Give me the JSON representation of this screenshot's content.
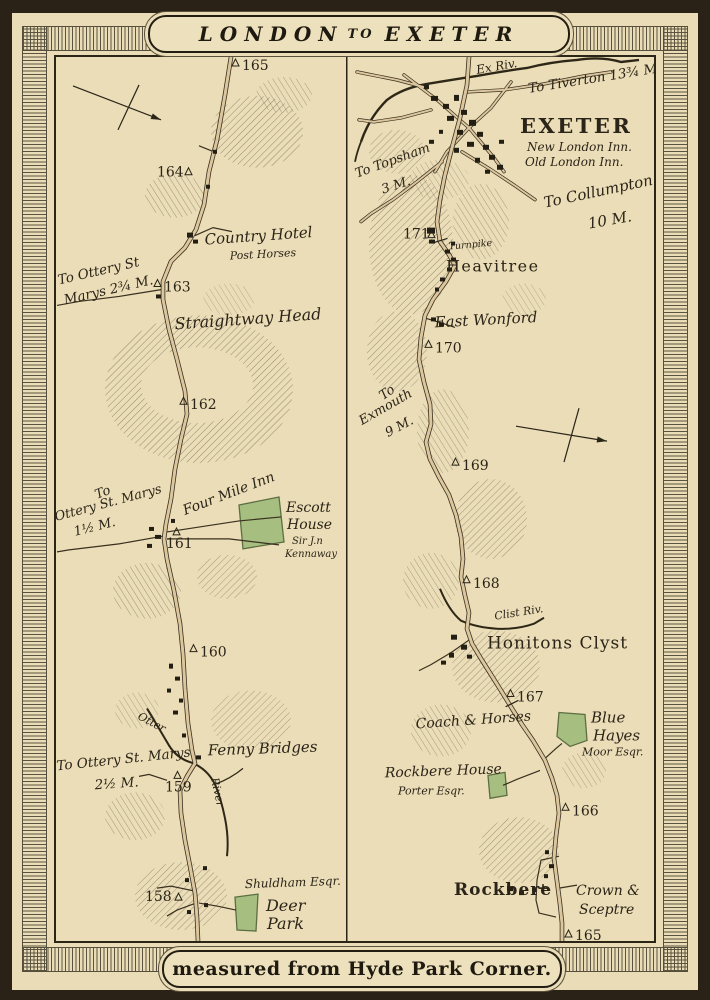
{
  "banners": {
    "title_left": "LONDON",
    "title_mid": "TO",
    "title_right": "EXETER",
    "footer": "measured from Hyde Park Corner."
  },
  "left": {
    "markers": [
      "165",
      "164",
      "163",
      "162",
      "161",
      "160",
      "159",
      "158"
    ],
    "labels": {
      "country_hotel": "Country Hotel",
      "post_horses": "Post Horses",
      "ottery_a1": "To Ottery St",
      "ottery_a2": "Marys 2¾ M.",
      "straightway_head": "Straightway Head",
      "ottery_b1": "To",
      "ottery_b2": "Ottery St. Marys",
      "ottery_b3": "1½ M.",
      "four_mile_inn": "Four Mile Inn",
      "escott_1": "Escott",
      "escott_2": "House",
      "escott_3": "Sir J.n",
      "escott_4": "Kennaway",
      "otter_river": "Otter",
      "fenny_bridges": "Fenny Bridges",
      "ottery_c1": "To Ottery St. Marys",
      "ottery_c2": "2½ M.",
      "river": "River",
      "shuldham": "Shuldham Esqr.",
      "deer_1": "Deer",
      "deer_2": "Park"
    }
  },
  "right": {
    "markers": [
      "171",
      "170",
      "169",
      "168",
      "167",
      "166",
      "165"
    ],
    "labels": {
      "ex_riv": "Ex Riv.",
      "tiverton": "To Tiverton 13¾ M.",
      "exeter": "EXETER",
      "new_london_inn": "New London Inn.",
      "old_london_inn": "Old London Inn.",
      "topsham_1": "To Topsham",
      "topsham_2": "3 M.",
      "collumpton_1": "To Collumpton",
      "collumpton_2": "10 M.",
      "turnpike": "Turnpike",
      "heavitree": "Heavitree",
      "east_wonford": "East Wonford",
      "exmouth_1": "To",
      "exmouth_2": "Exmouth",
      "exmouth_3": "9 M.",
      "clist_riv": "Clist Riv.",
      "honitons_clyst": "Honitons Clyst",
      "coach_horses": "Coach & Horses",
      "blue_1": "Blue",
      "blue_2": "Hayes",
      "blue_3": "Moor Esqr.",
      "rockbere_house": "Rockbere House",
      "porter": "Porter Esqr.",
      "rockbere": "Rockbere",
      "crown_1": "Crown &",
      "crown_2": "Sceptre"
    }
  },
  "colors": {
    "parchment": "#e9dcb6",
    "road": "#dcc69e",
    "ink": "#2b2518",
    "park_green": "#a6bf80",
    "frame": "#2a2216"
  }
}
